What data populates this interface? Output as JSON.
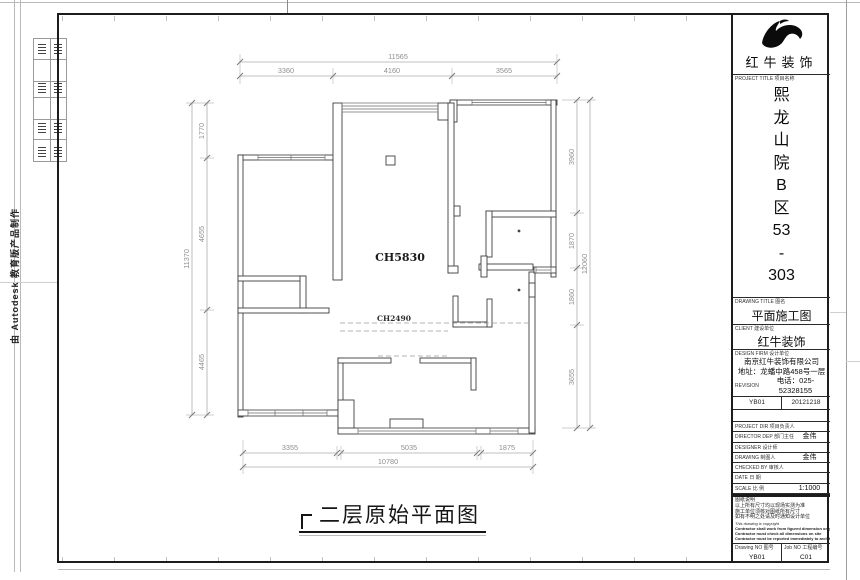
{
  "sheet": {
    "edge_text": "由 Autodesk 教育版产品制作",
    "caption": "二层原始平面图"
  },
  "plan": {
    "room_height_label": "CH5830",
    "opening_height_label": "CH2490",
    "dims": {
      "top": {
        "total": "11565",
        "segments": [
          "3360",
          "4160",
          "3565"
        ]
      },
      "left": {
        "total": "11370",
        "segments": [
          "1770",
          "4655",
          "4465"
        ]
      },
      "right": {
        "total": "12060",
        "segments": [
          "3960",
          "1870",
          "1860",
          "3655"
        ]
      },
      "bottom": {
        "total": "10780",
        "segments": [
          "3355",
          "5035",
          "1875"
        ]
      }
    }
  },
  "titleblock": {
    "brand": "红牛装饰",
    "project_label": "PROJECT TITLE 项目名称",
    "project_name": "熙龙山院B区53-303",
    "project_lines": [
      "熙",
      "龙",
      "山",
      "院",
      "B",
      "区",
      "53",
      "-",
      "303"
    ],
    "drawing_title_label": "DRAWING TITLE 图名",
    "drawing_title": "平面施工图",
    "client_label": "CLIENT 建设单位",
    "client": "红牛装饰",
    "company_label": "DESIGN FIRM 设计单位",
    "company": "南京红牛装饰有限公司",
    "address": "地址：龙蟠中路458号一层",
    "phone_label": "REVISION",
    "phone": "电话：025-52328155",
    "code": "YB01",
    "date": "20121218",
    "rows": [
      {
        "label": "PROJECT DIR 项目负责人",
        "value": ""
      },
      {
        "label": "DIRECTOR DEP 部门主任",
        "value": "金伟"
      },
      {
        "label": "DESIGNER 设计师",
        "value": ""
      },
      {
        "label": "DRAWING 制图人",
        "value": "金伟"
      },
      {
        "label": "CHECKED BY 审核人",
        "value": ""
      },
      {
        "label": "DATE 日 期",
        "value": ""
      },
      {
        "label": "SCALE 比 例",
        "value": "1:1000"
      }
    ],
    "notes": [
      "图纸说明",
      "以上所有尺寸均以现场实测为准",
      "施工单位须核对图纸所有尺寸",
      "如有不明之处请及时通知设计单位",
      "This drawing is copyright",
      "Contractor shall work from figured dimension only",
      "Contractor must check all dimensions on site",
      "Contractor must be reported immediately to architects"
    ],
    "drawing_no_label": "Drawing NO 图号",
    "drawing_no": "YB01",
    "job_no_label": "Job NO 工程编号",
    "job_no": "C01"
  }
}
